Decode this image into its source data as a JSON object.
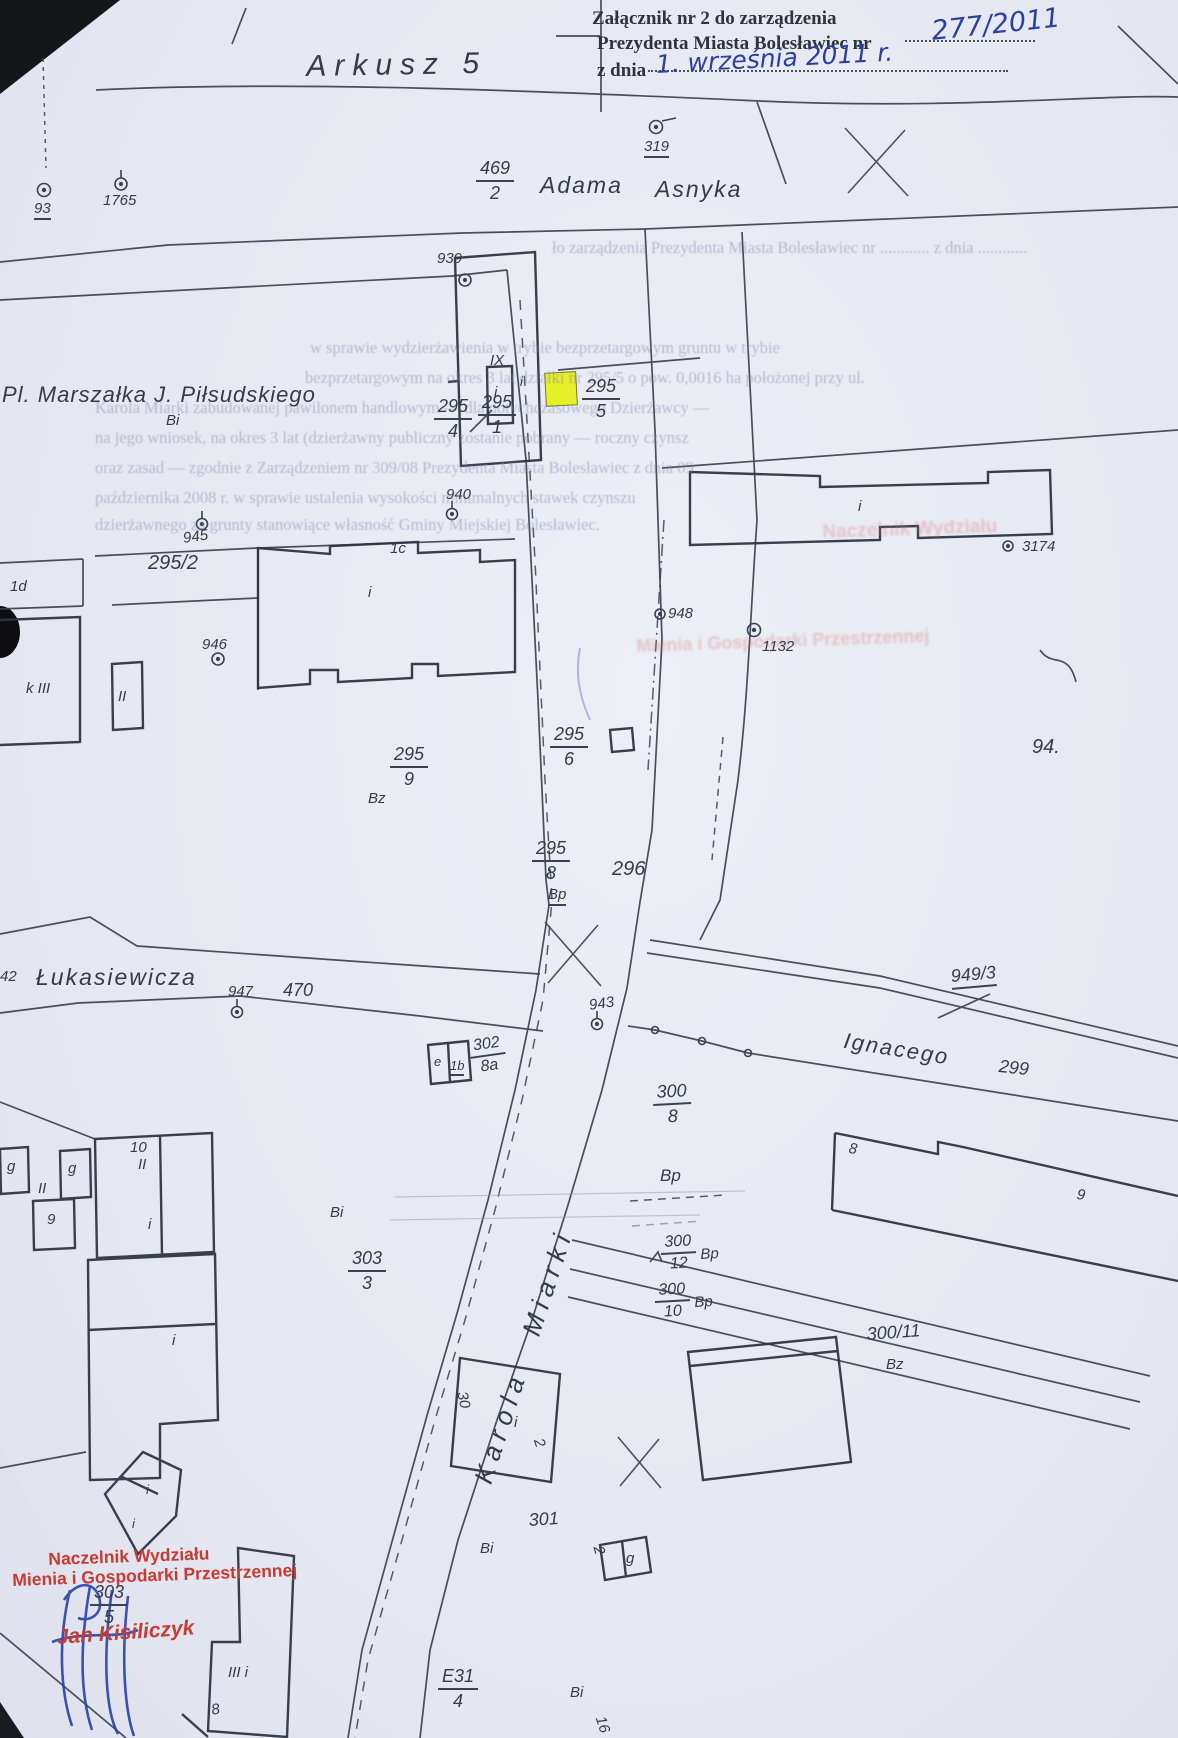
{
  "colors": {
    "paper": "#e8eaf3",
    "ink": "#3a4150",
    "blue_ink": "#2b3f9e",
    "stamp_red": "#c63b32",
    "highlight_yellow": "#e7ef15",
    "ghost": "#8289ad"
  },
  "header": {
    "attachment_line1": "Załącznik nr 2 do zarządzenia",
    "attachment_line2": "Prezydenta Miasta Bolesławiec nr",
    "attachment_number": "277/2011",
    "z_dnia": "z dnia",
    "date_handwritten": "1. września 2011 r.",
    "sheet_title": "Arkusz 5"
  },
  "streets": {
    "asnyka_word1": "Adama",
    "asnyka_word2": "Asnyka",
    "pilsudskiego": "Pl. Marszałka J. Piłsudskiego",
    "lukasiewicza": "Łukasiewicza",
    "ignacego": "Ignacego",
    "karola_miarki": "Karola  Miarki"
  },
  "markers": {
    "m93": "93",
    "m1765": "1765",
    "m319": "319",
    "m939": "939",
    "m940": "940",
    "m943": "943",
    "m945": "945",
    "m946": "946",
    "m947": "947",
    "m948": "948",
    "m1132": "1132",
    "m3174": "3174"
  },
  "parcels": {
    "p469": {
      "num": "469",
      "den": "2"
    },
    "p295_1": {
      "num": "295",
      "den": "1"
    },
    "p295_4": {
      "num": "295",
      "den": "4"
    },
    "p295_5": {
      "num": "295",
      "den": "5"
    },
    "p295_9": {
      "num": "295",
      "den": "9"
    },
    "p295_6": {
      "num": "295",
      "den": "6"
    },
    "p295_8": {
      "num": "295",
      "den": "8"
    },
    "p300_8": {
      "num": "300",
      "den": "8"
    },
    "p300_12": {
      "num": "300",
      "den": "12"
    },
    "p300_10": {
      "num": "300",
      "den": "10"
    },
    "p303_3": {
      "num": "303",
      "den": "3"
    },
    "p303_5": {
      "num": "303",
      "den": "5"
    },
    "p302_8a": {
      "num": "302",
      "den": "8a"
    },
    "pE31": {
      "num": "E31",
      "den": "4"
    },
    "p295_2": "295/2",
    "p296": "296",
    "p299": "299",
    "p301": "301",
    "p470": "470",
    "p300_11": "300/11",
    "p949_3": "949/3",
    "p42": "42",
    "p94": "94.",
    "p30": "30",
    "p16": "16"
  },
  "areas": {
    "bi1": "Bi",
    "bi2": "Bi",
    "bi3": "Bi",
    "bi4": "Bi",
    "bz1": "Bz",
    "bz2": "Bz",
    "bp1": "Bp",
    "bp2": "Bp",
    "bp3": "Bp",
    "bp4": "Bp"
  },
  "buildings": {
    "b1d": "1d",
    "bkIII": "k III",
    "bII": "II",
    "b1c": "1c",
    "bi_c": "i",
    "bi_a": "i",
    "bIX": "IX",
    "bi_b": "i",
    "bi_g": "i",
    "b8h": "8",
    "b9h": "9",
    "bi_i": "i",
    "b2i": "2",
    "b2g_2": "2",
    "b2g_g": "g",
    "bIIIi": "III i",
    "b8k": "8",
    "bg1": "g",
    "bg2": "g",
    "bII2": "II",
    "b9bl": "9",
    "b10": "10",
    "bII3": "II",
    "bi_4": "i",
    "bi_5": "i",
    "bi_7a": "i",
    "bi_7b": "i",
    "e1b_e": "e",
    "e1b_1b": "1b"
  },
  "stamp": {
    "line1": "Naczelnik Wydziału",
    "line2": "Mienia i Gospodarki Przestrzennej",
    "name": "Jan Kisiliczyk"
  },
  "ghost": {
    "l0": "ło zarządzenia Prezydenta Miasta Bolesławiec nr ............  z dnia ............",
    "l1": "w sprawie wydzierżawienia w trybie bezprzetargowym  gruntu w trybie",
    "l2": "bezprzetargowym  na okres 3 lat  działki nr 295/5 o pow. 0,0016 ha  położonej przy ul.",
    "l3": "Karola Miarki zabudowanej pawilonem handlowym  —  dla dotychczasowego Dzierżawcy —",
    "l4": "na jego wniosek,  na okres 3 lat  (dzierżawny  publiczny  zostanie pobrany  —  roczny czynsz",
    "l5": "oraz zasad —  zgodnie z Zarządzeniem nr 309/08 Prezydenta Miasta Bolesławiec z dnia 09",
    "l6": "października 2008 r.  w sprawie ustalenia wysokości minimalnych stawek czynszu",
    "l7": "dzierżawnego za grunty stanowiące własność Gminy Miejskiej Bolesławiec.",
    "red1": "Naczelnik Wydziału",
    "red2": "Mienia i Gospodarki Przestrzennej"
  }
}
